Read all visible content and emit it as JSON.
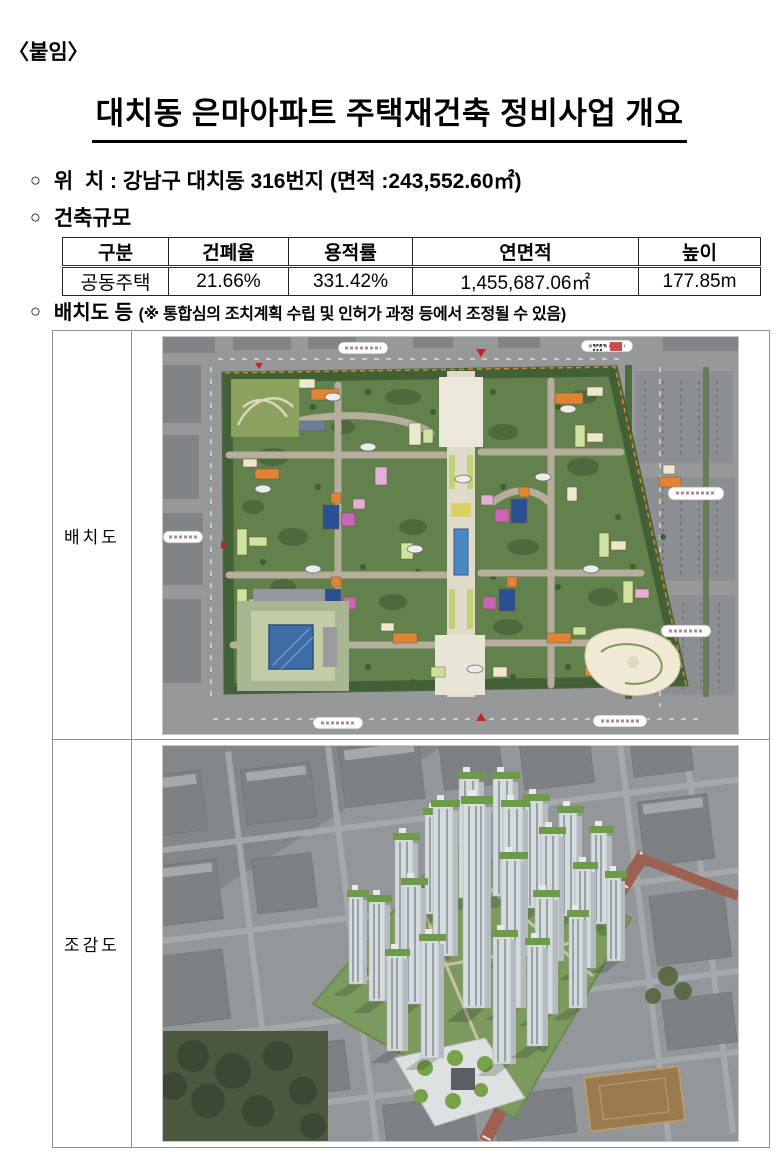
{
  "document": {
    "attachment_label": "〈붙임〉",
    "title": "대치동 은마아파트 주택재건축 정비사업 개요",
    "bullet_marker": "○"
  },
  "location": {
    "label": "위  치 : ",
    "value": "강남구 대치동 316번지 (면적 :243,552.60㎡)"
  },
  "building_scale": {
    "heading": "건축규모",
    "table": {
      "headers": [
        "구분",
        "건폐율",
        "용적률",
        "연면적",
        "높이"
      ],
      "row": [
        "공동주택",
        "21.66%",
        "331.42%",
        "1,455,687.06㎡",
        "177.85m"
      ]
    }
  },
  "layout_section": {
    "heading": "배치도 등 ",
    "note": "(※ 통합심의 조치계획 수립 및 인허가 과정 등에서 조정될 수 있음)"
  },
  "figure_table": {
    "rows": [
      {
        "label": "배치도",
        "figure": "site-plan"
      },
      {
        "label": "조감도",
        "figure": "birds-eye-view"
      }
    ]
  }
}
